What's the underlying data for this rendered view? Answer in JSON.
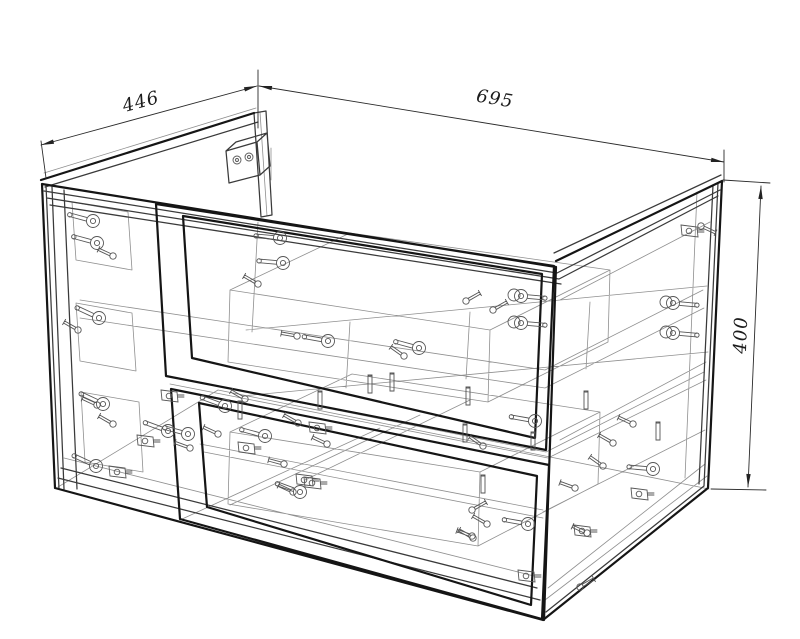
{
  "drawing": {
    "dimensions": {
      "depth": {
        "label": "446"
      },
      "width": {
        "label": "695"
      },
      "height": {
        "label": "400"
      }
    },
    "colors": {
      "heavy": "#151515",
      "medium": "#3a3a3a",
      "light": "#8f8f8f",
      "fastener": "#565656",
      "dimension": "#2b2b2b",
      "background": "#ffffff"
    }
  },
  "geometry": {
    "heavy": [
      "M42 184 L556 267",
      "M42 184 L55 488",
      "M55 488 L543 620",
      "M556 267 L544 620",
      "M556 261 L722 181",
      "M722 181 L708 488",
      "M708 488 L543 620",
      "M41 180 L254 113",
      "M156 204 L554 266 L546 450 L166 376 Z",
      "M183 216 L542 274 L535 438 L192 358 Z",
      "M171 389 L549 465 L542 619 L180 519 Z",
      "M199 403 L537 476 L531 605 L207 507 Z"
    ],
    "medium": [
      "M46 185 L59 489",
      "M52 187 L64 489",
      "M64 190 L77 489",
      "M44 191 L557 273",
      "M47 198 L559 279",
      "M50 205 L561 284",
      "M557 273 L720 190",
      "M559 279 L718 196",
      "M554 253 L721 175",
      "M718 183 L704 486",
      "M713 185 L699 484",
      "M704 486 L546 612",
      "M45 187 L258 122",
      "M254 113 L266 111 L272 215 L261 217 Z",
      "M226 151 L257 142 L260 175 L229 183 Z",
      "M226 151 L257 142 L267 133 L236 142 Z",
      "M257 142 L267 133 L270 166 L260 175 Z",
      "M58 478 L540 600",
      "M61 468 L537 588"
    ],
    "light": [
      "M44 173 L256 108",
      "M260 112 L267 216",
      "M64 458 L534 576",
      "M72 202 L128 212 L132 270 L76 260 Z",
      "M76 303 L132 313 L136 371 L80 361 Z",
      "M81 392 L139 402 L143 472 L85 462 Z",
      "M80 300 L545 370",
      "M80 318 L545 388",
      "M166 376 L546 452",
      "M170 384 L548 458",
      "M200 444 L543 510",
      "M204 452 L543 518",
      "M546 452 L704 372",
      "M548 458 L706 380",
      "M545 370 L703 290",
      "M545 388 L704 308",
      "M543 512 L705 430",
      "M545 600 L707 476",
      "M548 588 L705 464",
      "M246 330 L707 286",
      "M242 396 L708 352",
      "M350 322 L346 388",
      "M470 312 L466 379",
      "M590 302 L586 369",
      "M258 222 L252 332",
      "M218 390 L709 489",
      "M58 487 L218 390",
      "M230 290 L490 330 L610 270 L350 233 Z",
      "M230 290 L228 362 L488 402 L490 330",
      "M610 270 L608 342 L488 402",
      "M230 432 L480 472 L600 412 L352 374 Z",
      "M230 432 L228 504 L478 546 L480 472",
      "M600 412 L598 484 L478 546",
      "M560 300 L710 222",
      "M560 440 L706 362",
      "M697 192 L685 478",
      "M230 505 L420 415",
      "M180 520 L380 428",
      "M305 480 L470 400",
      "M271 148 L271 180"
    ],
    "dims": [
      {
        "key": "depth",
        "line": [
          41,
          145,
          257,
          86
        ],
        "exts": [
          [
            46,
            178,
            41,
            141
          ],
          [
            258,
            128,
            258,
            70
          ]
        ],
        "arrows": [
          [
            41,
            145,
            165
          ],
          [
            257,
            86,
            -15
          ]
        ]
      },
      {
        "key": "width",
        "line": [
          259,
          86,
          724,
          162
        ],
        "exts": [
          [
            724,
            150,
            724,
            182
          ]
        ],
        "arrows": [
          [
            259,
            86,
            189.4
          ],
          [
            724,
            162,
            9.4
          ]
        ]
      },
      {
        "key": "height",
        "line": [
          761,
          186,
          748,
          487
        ],
        "exts": [
          [
            723,
            180,
            770,
            183
          ],
          [
            711,
            489,
            766,
            490
          ]
        ],
        "arrows": [
          [
            761,
            186,
            -87.7
          ],
          [
            748,
            487,
            92.3
          ]
        ]
      }
    ],
    "fasteners": [
      [
        93,
        221,
        "cam",
        195
      ],
      [
        97,
        243,
        "cam",
        195
      ],
      [
        113,
        256,
        "screw",
        205
      ],
      [
        99,
        318,
        "cam",
        205
      ],
      [
        78,
        330,
        "screw",
        210
      ],
      [
        103,
        404,
        "cam",
        205
      ],
      [
        113,
        424,
        "screw",
        210
      ],
      [
        96,
        466,
        "cam",
        205
      ],
      [
        118,
        472,
        "box",
        0
      ],
      [
        146,
        441,
        "box",
        0
      ],
      [
        168,
        431,
        "cam",
        200
      ],
      [
        188,
        434,
        "cam",
        195
      ],
      [
        280,
        238,
        "cam",
        185
      ],
      [
        283,
        263,
        "cam",
        185
      ],
      [
        258,
        284,
        "screw",
        210
      ],
      [
        328,
        341,
        "cam",
        190
      ],
      [
        297,
        336,
        "screw",
        190
      ],
      [
        419,
        348,
        "cam",
        195
      ],
      [
        404,
        356,
        "screw",
        215
      ],
      [
        493,
        310,
        "screw",
        -30
      ],
      [
        466,
        301,
        "screw",
        -30
      ],
      [
        521,
        296,
        "cam2",
        5
      ],
      [
        521,
        323,
        "cam2",
        5
      ],
      [
        673,
        303,
        "cam2",
        5
      ],
      [
        673,
        333,
        "cam2",
        5
      ],
      [
        690,
        231,
        "box",
        0
      ],
      [
        701,
        226,
        "screw",
        25
      ],
      [
        247,
        448,
        "box",
        0
      ],
      [
        265,
        436,
        "cam",
        195
      ],
      [
        298,
        423,
        "screw",
        210
      ],
      [
        284,
        464,
        "screw",
        195
      ],
      [
        300,
        492,
        "cam",
        200
      ],
      [
        318,
        428,
        "box",
        0
      ],
      [
        327,
        444,
        "screw",
        205
      ],
      [
        313,
        483,
        "box",
        0
      ],
      [
        535,
        421,
        "cam",
        190
      ],
      [
        483,
        446,
        "screw",
        215
      ],
      [
        633,
        424,
        "screw",
        205
      ],
      [
        613,
        443,
        "screw",
        210
      ],
      [
        603,
        466,
        "screw",
        215
      ],
      [
        653,
        469,
        "cam",
        185
      ],
      [
        640,
        494,
        "box",
        0
      ],
      [
        583,
        531,
        "box",
        0
      ],
      [
        528,
        524,
        "cam",
        190
      ],
      [
        487,
        524,
        "screw",
        210
      ],
      [
        527,
        576,
        "box",
        0
      ],
      [
        472,
        536,
        "screw",
        200
      ],
      [
        97,
        405,
        "screw",
        205
      ],
      [
        170,
        396,
        "box",
        0
      ],
      [
        218,
        434,
        "screw",
        205
      ],
      [
        190,
        448,
        "screw",
        200
      ],
      [
        245,
        399,
        "screw",
        210
      ],
      [
        225,
        406,
        "cam",
        200
      ],
      [
        305,
        480,
        "box",
        0
      ],
      [
        293,
        492,
        "screw",
        205
      ],
      [
        473,
        538,
        "screw",
        210
      ],
      [
        472,
        510,
        "screw",
        -30
      ],
      [
        575,
        488,
        "screw",
        200
      ],
      [
        587,
        533,
        "screw",
        205
      ],
      [
        580,
        587,
        "screw",
        -30
      ],
      [
        237,
        160,
        "hole",
        0
      ],
      [
        249,
        157,
        "hole",
        0
      ]
    ],
    "pins": [
      [
        240,
        410
      ],
      [
        320,
        400
      ],
      [
        370,
        384
      ],
      [
        392,
        382
      ],
      [
        468,
        396
      ],
      [
        465,
        433
      ],
      [
        533,
        441
      ],
      [
        658,
        431
      ],
      [
        586,
        400
      ],
      [
        483,
        484
      ]
    ]
  }
}
